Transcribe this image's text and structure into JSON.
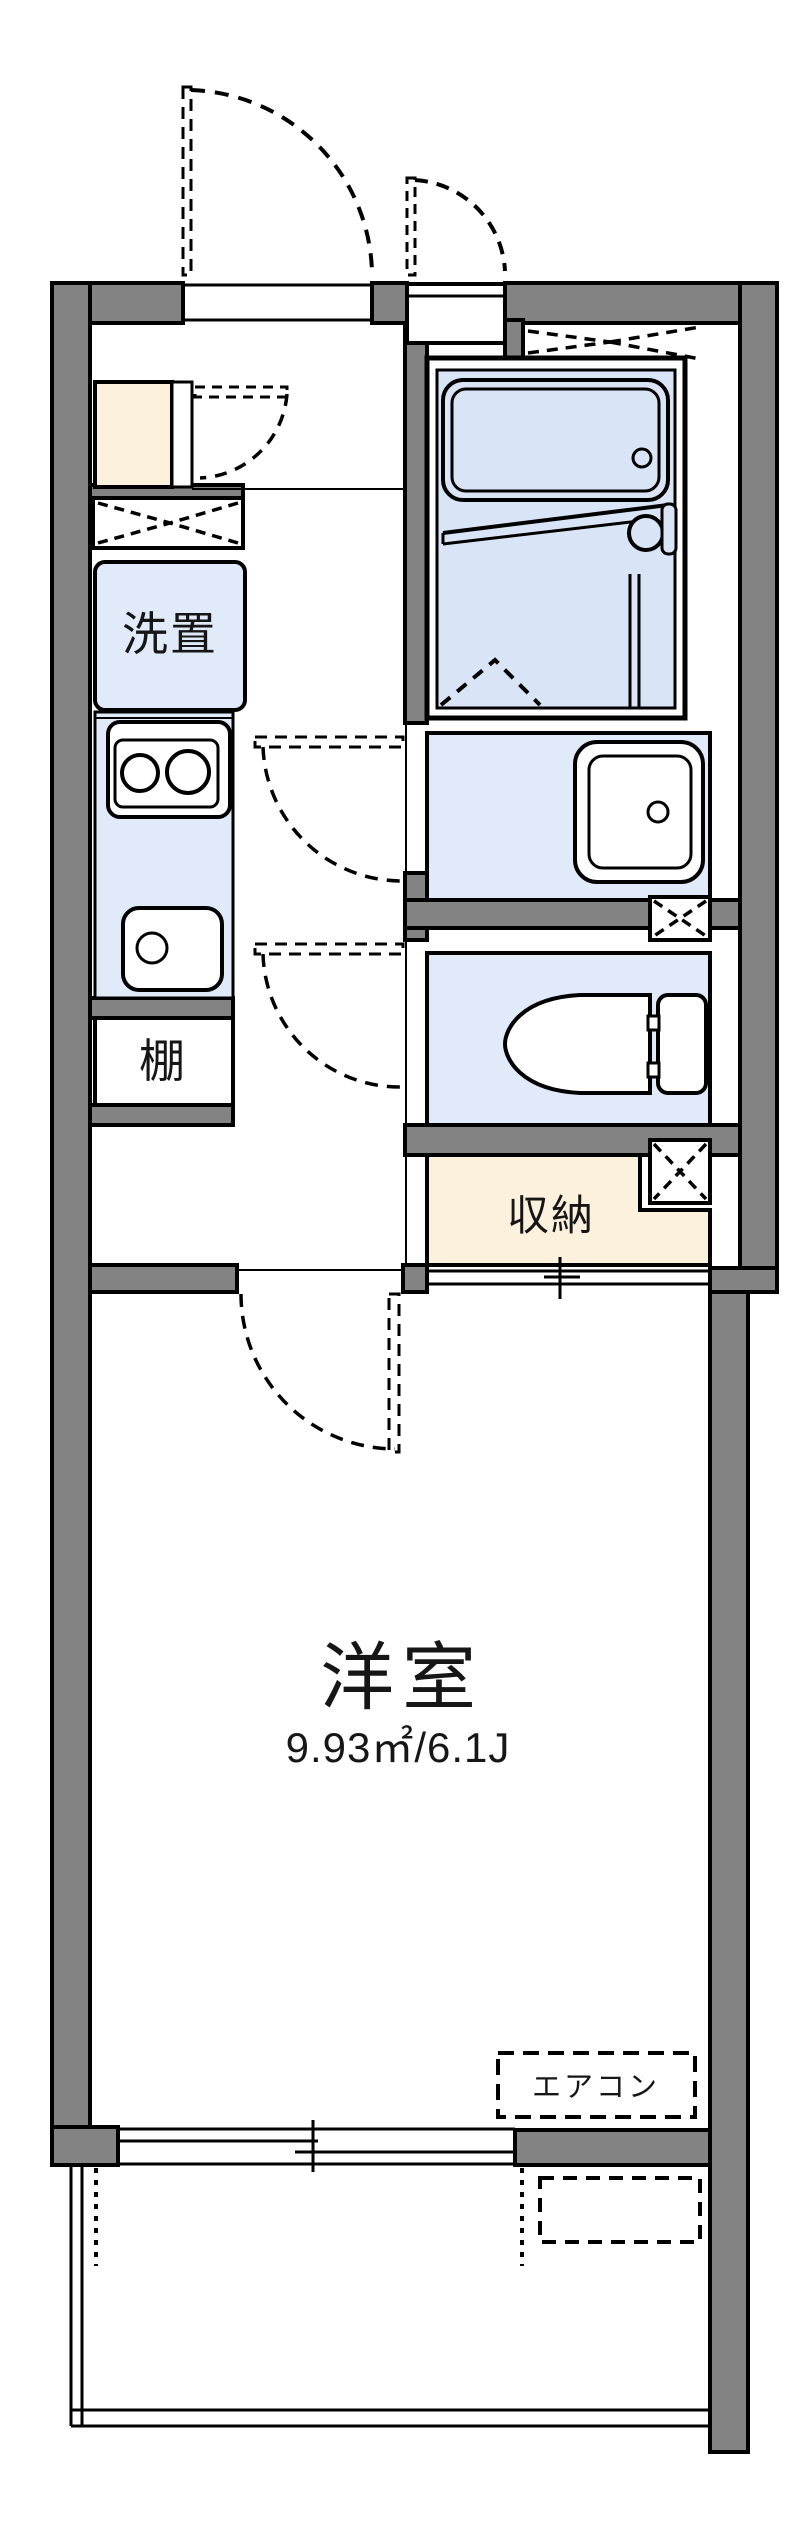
{
  "plan": {
    "type": "japanese-apartment-floor-plan",
    "labels": {
      "washer_place": "洗置",
      "shelf": "棚",
      "storage": "収納",
      "western_room": "洋室",
      "western_room_area": "9.93㎡/6.1J",
      "aircon": "エアコン"
    },
    "fixtures": [
      "bathtub-icon",
      "bath-faucet-icon",
      "kitchen-stove-icon",
      "kitchen-sink-icon",
      "wash-basin-icon",
      "toilet-icon",
      "shoe-cabinet",
      "washing-machine-space",
      "pipe-space-box",
      "door-swing-arc",
      "sliding-window",
      "balcony"
    ],
    "colors": {
      "wall_gray": "#838383",
      "room_blue": "#e0eaf8",
      "bath_blue": "#d9e5f6",
      "storage_cream": "#fbf1dc",
      "line_black": "#000000",
      "background": "#ffffff"
    }
  }
}
